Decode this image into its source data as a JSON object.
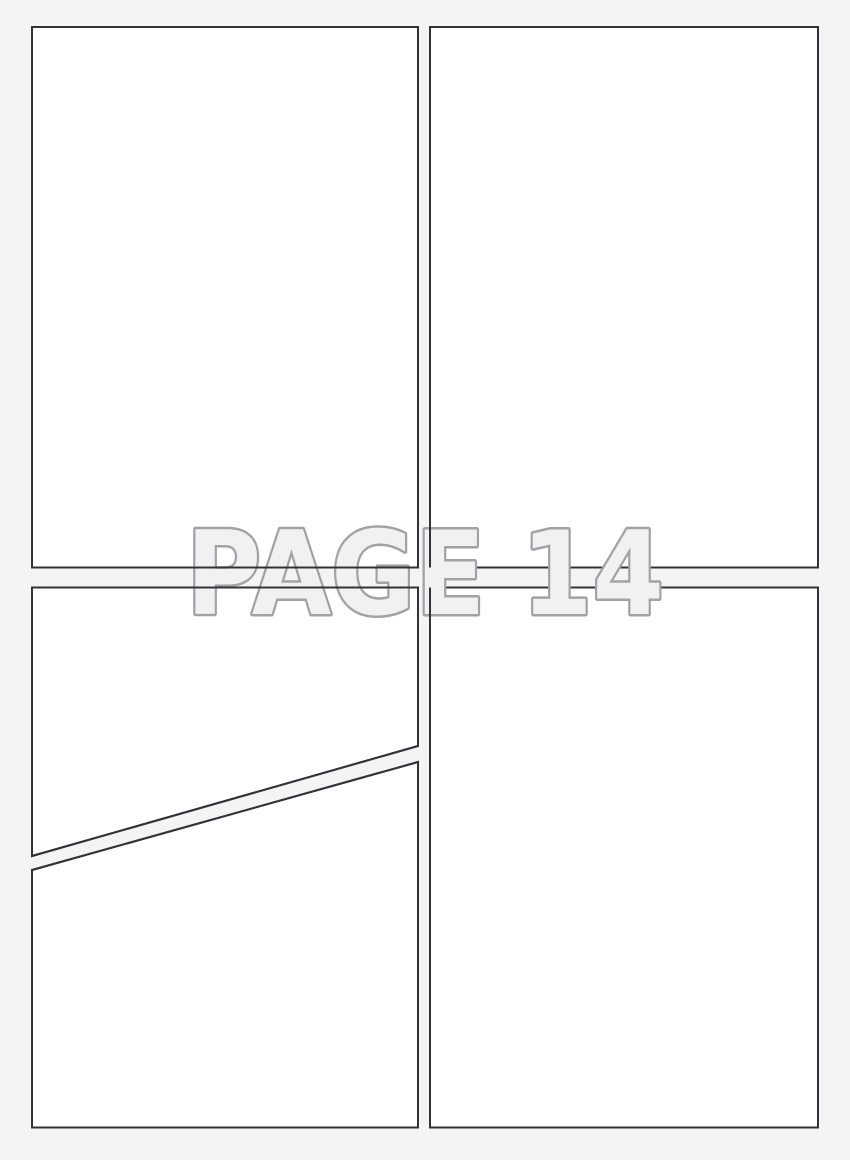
{
  "page": {
    "label": "PAGE 14",
    "background_color": "#f4f4f5",
    "panel_fill_color": "#ffffff",
    "panel_border_color": "#323338",
    "panel_border_width": 2,
    "watermark_fill_color": "#f1f1f2",
    "watermark_outline_color": "#a1a1a6",
    "watermark_outline_width": 5
  },
  "watermark": {
    "text": "PAGE 14",
    "x": 425,
    "baseline_y": 614,
    "font_size": 116,
    "text_length": 478
  },
  "panels": [
    {
      "id": "panel-top-left",
      "points": "32,27 418,27 418,567.5 32,567.5",
      "restroke_over_watermark": true
    },
    {
      "id": "panel-top-right",
      "points": "430,27 818,27 818,567.5 430,567.5",
      "restroke_over_watermark": false
    },
    {
      "id": "panel-bottom-left-upper",
      "points": "32,587.5 418,587.5 418,746 32,856",
      "restroke_over_watermark": true
    },
    {
      "id": "panel-bottom-left-lower",
      "points": "32,870 418,762 418,1127.5 32,1127.5",
      "restroke_over_watermark": true
    },
    {
      "id": "panel-bottom-right",
      "points": "430,587.5 818,587.5 818,1127.5 430,1127.5",
      "restroke_over_watermark": false
    }
  ],
  "overlay_lines": [
    {
      "id": "gutter-vertical-top",
      "x1": 430,
      "y1": 27,
      "x2": 430,
      "y2": 567.5
    },
    {
      "id": "gutter-vertical-bottom",
      "x1": 430,
      "y1": 587.5,
      "x2": 430,
      "y2": 1127.5
    }
  ]
}
